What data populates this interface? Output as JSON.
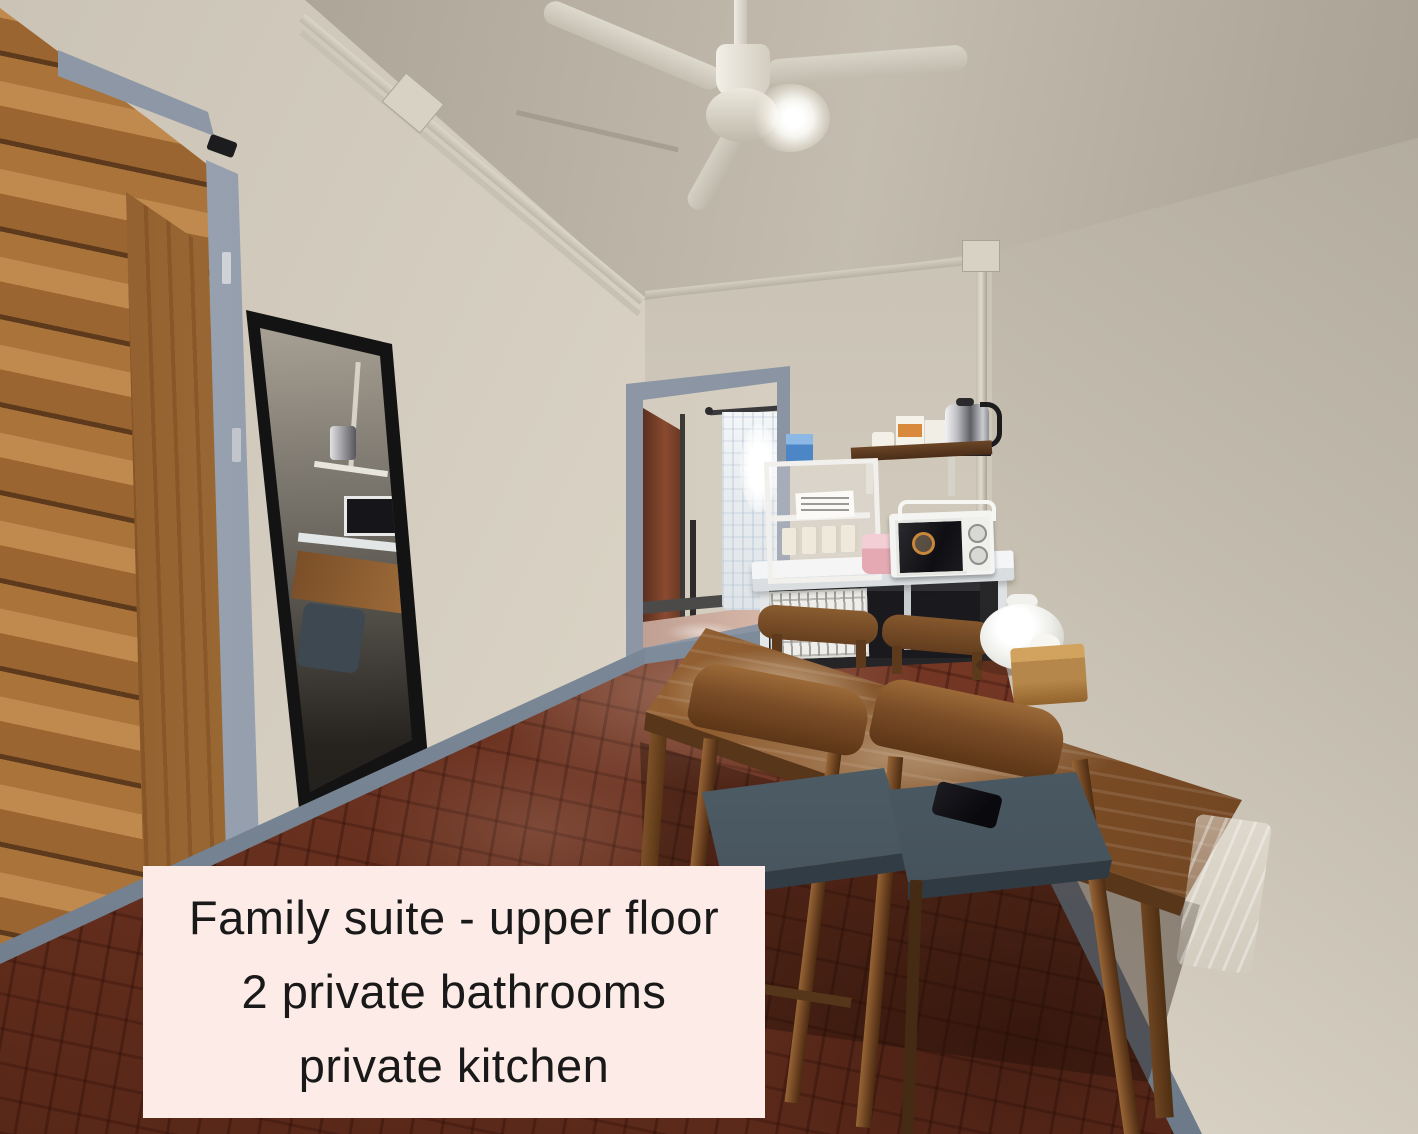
{
  "caption": {
    "line1": "Family suite - upper floor",
    "line2": "2 private bathrooms",
    "line3": "private kitchen",
    "background_color": "#fcebe7",
    "text_color": "#191919"
  },
  "scene": {
    "type": "photograph",
    "setting": "narrow dining and kitchen corner of a guesthouse family suite",
    "objects": [
      "ceiling-fan",
      "ceiling-light-glare",
      "conduit-pipes",
      "wooden-plank-door",
      "blue-grey-door-frame",
      "full-length-mirror",
      "doorway-to-second-room",
      "window-with-sheer-curtain",
      "inner-red-door",
      "wall-shelf",
      "electric-kettle",
      "supply-boxes",
      "cup-rack",
      "blue-box",
      "pink-container",
      "microwave-oven",
      "white-counter-table",
      "wire-basket",
      "black-appliance",
      "dining-table-with-glossy-cover",
      "wooden-chairs-with-grey-seats",
      "smartphone-on-chair",
      "white-food-cover-dome",
      "wooden-tissue-box",
      "parquet-floor",
      "blue-grey-baseboard"
    ]
  },
  "palette": {
    "wall": "#d7d0c2",
    "ceiling": "#b4ac9f",
    "floor": "#7c3a26",
    "door_wood": "#a9733a",
    "frame_blue_grey": "#8a94a3",
    "mirror_frame": "#131313",
    "caption_bg": "#fcebe7",
    "caption_text": "#191919"
  }
}
